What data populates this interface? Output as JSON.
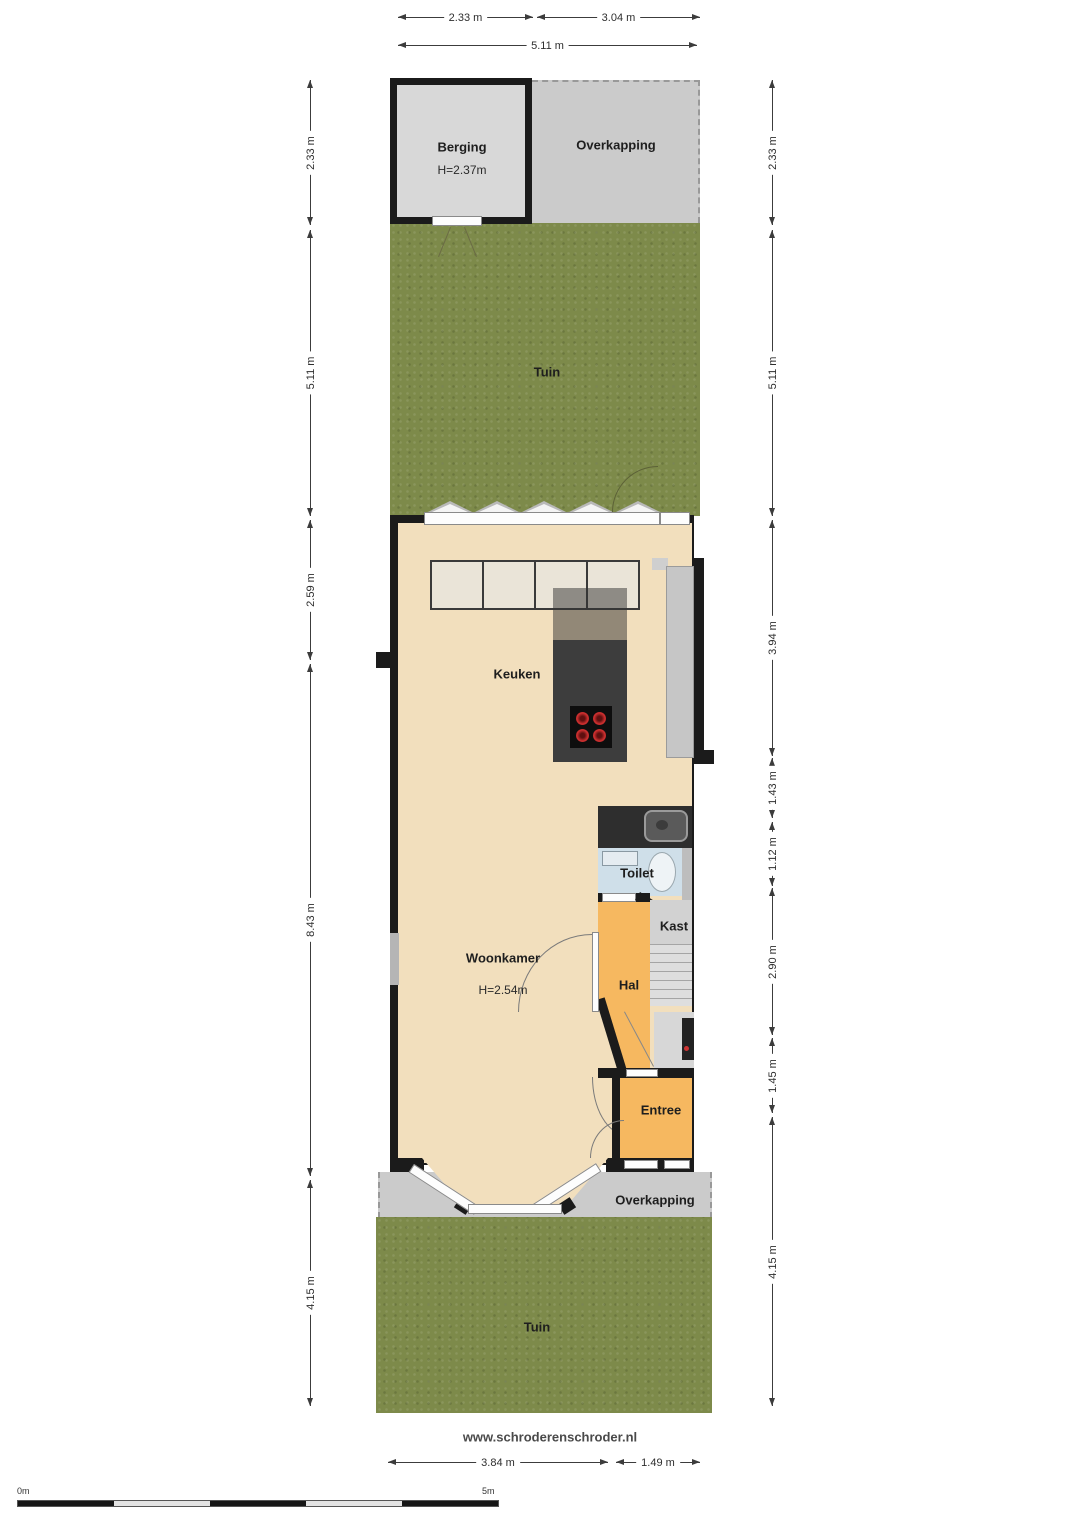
{
  "site": {
    "url_text": "www.schroderenschroder.nl"
  },
  "dims": {
    "top": [
      "2.33 m",
      "3.04 m",
      "5.11 m"
    ],
    "left": [
      "2.33 m",
      "5.11 m",
      "2.59 m",
      "8.43 m",
      "4.15 m"
    ],
    "right": [
      "2.33 m",
      "5.11 m",
      "3.94 m",
      "1.43 m",
      "1.12 m",
      "2.90 m",
      "1.45 m",
      "4.15 m"
    ],
    "bottom": [
      "3.84 m",
      "1.49 m"
    ]
  },
  "rooms": {
    "berging": "Berging",
    "berging_height": "H=2.37m",
    "overkapping_top": "Overkapping",
    "tuin_top": "Tuin",
    "keuken": "Keuken",
    "woonkamer": "Woonkamer",
    "woonkamer_height": "H=2.54m",
    "toilet": "Toilet",
    "kast": "Kast",
    "hal": "Hal",
    "entree": "Entree",
    "overkapping_bottom": "Overkapping",
    "tuin_bottom": "Tuin"
  },
  "scalebar": {
    "start": "0m",
    "end": "5m"
  },
  "colors": {
    "wall": "#1b1b1b",
    "floor_living": "#f2dfbd",
    "floor_hall": "#f6b860",
    "floor_toilet": "#cfdfe9",
    "grass": "#7d8a4a",
    "canopy": "#cbcbcb",
    "island": "#3d3d3d",
    "burner_red": "#cf3030"
  }
}
